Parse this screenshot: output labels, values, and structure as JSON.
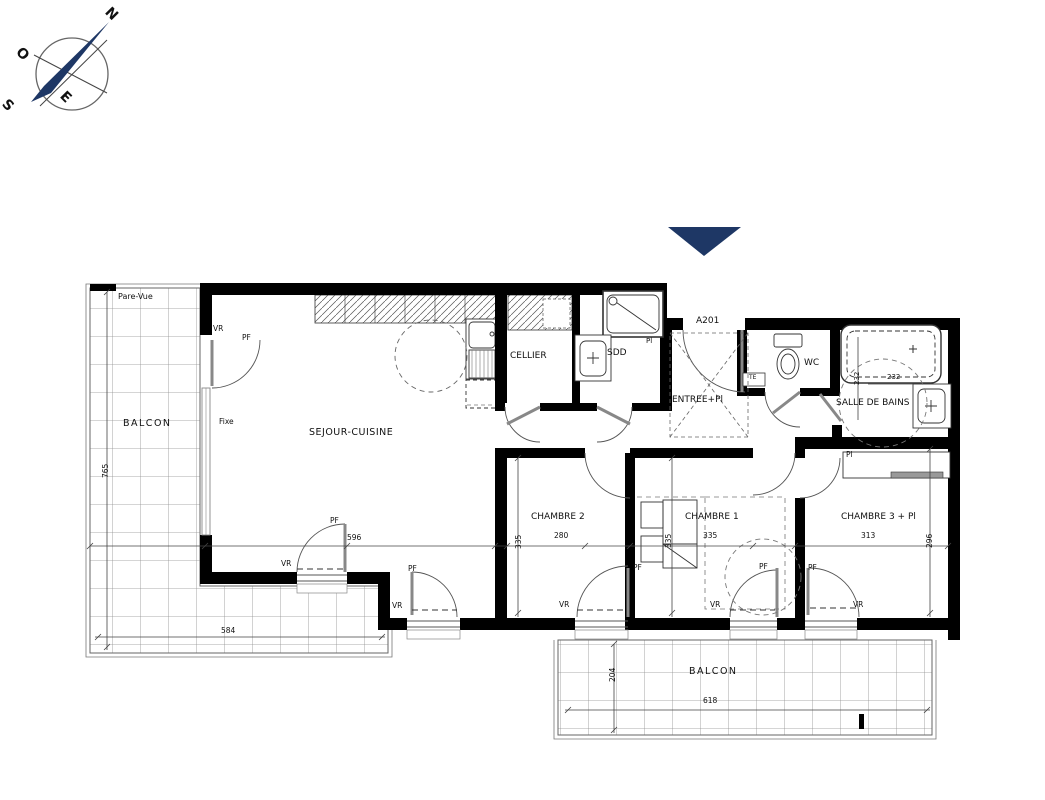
{
  "colors": {
    "walls": "#000000",
    "compass_needle": "#1e3765",
    "entrance_marker": "#1e3765"
  },
  "annotations": {
    "compass": [
      {
        "name": "compass-north-label",
        "text": "N",
        "x": 112,
        "y": 5,
        "size": 14,
        "rot": 45,
        "bold": true
      },
      {
        "name": "compass-west-label",
        "text": "O",
        "x": 23,
        "y": 45,
        "size": 14,
        "rot": 45,
        "bold": true
      },
      {
        "name": "compass-east-label",
        "text": "E",
        "x": 67,
        "y": 89,
        "size": 14,
        "rot": 45,
        "bold": true
      },
      {
        "name": "compass-south-label",
        "text": "S",
        "x": 9,
        "y": 97,
        "size": 14,
        "rot": 45,
        "bold": true
      }
    ],
    "balcony_left": [
      {
        "name": "pare-vue-label",
        "text": "Pare-Vue",
        "x": 118,
        "y": 293,
        "size": 8
      },
      {
        "name": "balcony-left-label",
        "text": "BALCON",
        "x": 123,
        "y": 419,
        "size": 9.5,
        "ls": 1.5
      },
      {
        "name": "dim-765",
        "text": "765",
        "x": 102,
        "y": 478,
        "size": 7.5,
        "rot": -90
      },
      {
        "name": "dim-584",
        "text": "584",
        "x": 221,
        "y": 627,
        "size": 7.5
      }
    ],
    "living": [
      {
        "name": "sejour-cuisine-label",
        "text": "SEJOUR-CUISINE",
        "x": 309,
        "y": 428,
        "size": 9.5,
        "ls": 0.5
      },
      {
        "name": "cellier-label",
        "text": "CELLIER",
        "x": 510,
        "y": 352,
        "size": 9
      },
      {
        "name": "vr-tag-left-window",
        "text": "VR",
        "x": 213,
        "y": 325,
        "size": 7.5
      },
      {
        "name": "pf-tag-left-window",
        "text": "PF",
        "x": 242,
        "y": 334,
        "size": 7.5
      },
      {
        "name": "fixe-label",
        "text": "Fixe",
        "x": 219,
        "y": 418,
        "size": 7.5
      },
      {
        "name": "pf-tag-sejour-door",
        "text": "PF",
        "x": 330,
        "y": 517,
        "size": 7.5
      },
      {
        "name": "dim-596",
        "text": "596",
        "x": 347,
        "y": 534,
        "size": 7.5
      },
      {
        "name": "vr-tag-sejour-door",
        "text": "VR",
        "x": 281,
        "y": 560,
        "size": 7.5
      },
      {
        "name": "pf-tag-sejour-window",
        "text": "PF",
        "x": 408,
        "y": 565,
        "size": 7.5
      },
      {
        "name": "vr-tag-sejour-window",
        "text": "VR",
        "x": 392,
        "y": 602,
        "size": 7.5
      }
    ],
    "service_rooms": [
      {
        "name": "sdd-label",
        "text": "SDD",
        "x": 607,
        "y": 349,
        "size": 9
      },
      {
        "name": "pl-tag-sdd",
        "text": "Pl",
        "x": 646,
        "y": 338,
        "size": 7
      }
    ],
    "entrance": [
      {
        "name": "unit-number-label",
        "text": "A201",
        "x": 696,
        "y": 317,
        "size": 9
      },
      {
        "name": "entree-label",
        "text": "ENTREE+Pl",
        "x": 672,
        "y": 396,
        "size": 9
      },
      {
        "name": "te-label",
        "text": "TE",
        "x": 749,
        "y": 375,
        "size": 6
      },
      {
        "name": "wc-label",
        "text": "WC",
        "x": 804,
        "y": 359,
        "size": 9
      }
    ],
    "bathroom": [
      {
        "name": "salle-de-bains-label",
        "text": "SALLE DE BAINS",
        "x": 836,
        "y": 399,
        "size": 9
      },
      {
        "name": "dim-232-vertical",
        "text": "232",
        "x": 854,
        "y": 385,
        "size": 7,
        "rot": -90
      },
      {
        "name": "dim-232-horizontal",
        "text": "232",
        "x": 887,
        "y": 374,
        "size": 7
      },
      {
        "name": "pl-tag-sdb-closet",
        "text": "Pl",
        "x": 846,
        "y": 451,
        "size": 7.5
      }
    ],
    "bedrooms": [
      {
        "name": "chambre2-label",
        "text": "CHAMBRE 2",
        "x": 531,
        "y": 513,
        "size": 9
      },
      {
        "name": "dim-280",
        "text": "280",
        "x": 554,
        "y": 532,
        "size": 7.5
      },
      {
        "name": "dim-335-chambre2",
        "text": "335",
        "x": 515,
        "y": 549,
        "size": 7.5,
        "rot": -90
      },
      {
        "name": "chambre1-label",
        "text": "CHAMBRE 1",
        "x": 685,
        "y": 513,
        "size": 9
      },
      {
        "name": "dim-335-chambre1-h",
        "text": "335",
        "x": 703,
        "y": 532,
        "size": 7.5
      },
      {
        "name": "dim-335-chambre1-v",
        "text": "335",
        "x": 665,
        "y": 548,
        "size": 7.5,
        "rot": -90
      },
      {
        "name": "chambre3-label",
        "text": "CHAMBRE 3 + Pl",
        "x": 841,
        "y": 513,
        "size": 9
      },
      {
        "name": "dim-313",
        "text": "313",
        "x": 861,
        "y": 532,
        "size": 7.5
      },
      {
        "name": "dim-296",
        "text": "296",
        "x": 926,
        "y": 548,
        "size": 7.5,
        "rot": -90
      },
      {
        "name": "pf-tag-chambre2",
        "text": "PF",
        "x": 633,
        "y": 564,
        "size": 7.5
      },
      {
        "name": "vr-tag-chambre2",
        "text": "VR",
        "x": 559,
        "y": 601,
        "size": 7.5
      },
      {
        "name": "pf-tag-chambre1",
        "text": "PF",
        "x": 759,
        "y": 563,
        "size": 7.5
      },
      {
        "name": "vr-tag-chambre1",
        "text": "VR",
        "x": 710,
        "y": 601,
        "size": 7.5
      },
      {
        "name": "pf-tag-chambre3",
        "text": "PF",
        "x": 808,
        "y": 564,
        "size": 7.5
      },
      {
        "name": "vr-tag-chambre3",
        "text": "VR",
        "x": 853,
        "y": 601,
        "size": 7.5
      }
    ],
    "balcony_bottom": [
      {
        "name": "balcony-bottom-label",
        "text": "BALCON",
        "x": 689,
        "y": 667,
        "size": 9.5,
        "ls": 1.5
      },
      {
        "name": "dim-618",
        "text": "618",
        "x": 703,
        "y": 697,
        "size": 7.5
      },
      {
        "name": "dim-204",
        "text": "204",
        "x": 609,
        "y": 682,
        "size": 7.5,
        "rot": -90
      }
    ]
  }
}
